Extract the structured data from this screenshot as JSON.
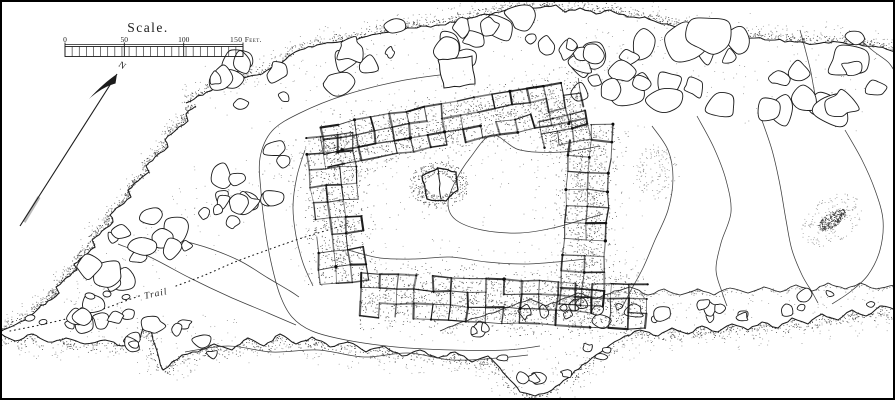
{
  "figure": {
    "kind": "archaeological-site-plan",
    "paper_color": "#ffffff",
    "ink_color": "#1c1c1c",
    "stipple_color": "#2e2e2e",
    "contour_color": "#3d3d3d"
  },
  "scale_bar": {
    "title": "Scale.",
    "labels": {
      "zero": "0",
      "fifty": "50",
      "hundred": "100",
      "end": "150 Feet."
    },
    "x0": 65,
    "x1": 243,
    "label_y": 41,
    "top_y": 44.5,
    "band_top": 46.5,
    "band_bottom": 56.5,
    "cells": 25
  },
  "north_arrow": {
    "label": "N",
    "tail": [
      20,
      226
    ],
    "tip": [
      117,
      74
    ],
    "label_pos": [
      122,
      65
    ],
    "label_rotation": 35
  },
  "trail": {
    "label": "Trail",
    "label_pos": [
      158,
      293
    ],
    "label_rotation": -12,
    "path_before": [
      [
        10,
        331
      ],
      [
        40,
        325
      ],
      [
        70,
        318
      ],
      [
        100,
        310
      ],
      [
        128,
        300
      ],
      [
        142,
        295
      ]
    ],
    "path_after": [
      [
        176,
        286
      ],
      [
        205,
        275
      ],
      [
        235,
        262
      ],
      [
        262,
        252
      ],
      [
        290,
        242
      ],
      [
        318,
        233
      ],
      [
        345,
        225
      ]
    ]
  },
  "cliffs": {
    "top_edge": [
      [
        186,
        103
      ],
      [
        215,
        88
      ],
      [
        242,
        78
      ],
      [
        262,
        74
      ],
      [
        285,
        60
      ],
      [
        300,
        50
      ],
      [
        322,
        44
      ],
      [
        352,
        40
      ],
      [
        382,
        33
      ],
      [
        412,
        28
      ],
      [
        440,
        25
      ],
      [
        470,
        18
      ],
      [
        500,
        12
      ],
      [
        530,
        8
      ],
      [
        556,
        5
      ],
      [
        565,
        12
      ],
      [
        580,
        8
      ],
      [
        596,
        14
      ],
      [
        610,
        10
      ],
      [
        628,
        17
      ],
      [
        645,
        17
      ],
      [
        662,
        24
      ],
      [
        680,
        27
      ],
      [
        700,
        29
      ],
      [
        715,
        33
      ],
      [
        735,
        37
      ],
      [
        755,
        38
      ],
      [
        775,
        40
      ],
      [
        795,
        42
      ],
      [
        815,
        44
      ],
      [
        838,
        42
      ],
      [
        858,
        44
      ],
      [
        878,
        47
      ],
      [
        895,
        52
      ]
    ],
    "left_edge": [
      [
        196,
        106
      ],
      [
        186,
        114
      ],
      [
        188,
        121
      ],
      [
        175,
        131
      ],
      [
        165,
        140
      ],
      [
        168,
        147
      ],
      [
        155,
        157
      ],
      [
        146,
        166
      ],
      [
        149,
        172
      ],
      [
        138,
        181
      ],
      [
        128,
        190
      ],
      [
        131,
        197
      ],
      [
        120,
        206
      ],
      [
        110,
        215
      ],
      [
        113,
        222
      ],
      [
        102,
        231
      ],
      [
        92,
        240
      ],
      [
        95,
        247
      ],
      [
        84,
        256
      ],
      [
        74,
        264
      ],
      [
        77,
        270
      ],
      [
        66,
        278
      ],
      [
        56,
        287
      ],
      [
        59,
        293
      ],
      [
        48,
        301
      ],
      [
        38,
        309
      ],
      [
        30,
        316
      ],
      [
        20,
        322
      ],
      [
        8,
        328
      ],
      [
        0,
        332
      ]
    ],
    "bottom_edge": [
      [
        0,
        333
      ],
      [
        15,
        341
      ],
      [
        32,
        334
      ],
      [
        48,
        342
      ],
      [
        66,
        338
      ],
      [
        85,
        344
      ],
      [
        105,
        340
      ],
      [
        122,
        346
      ],
      [
        138,
        342
      ],
      [
        147,
        320
      ],
      [
        155,
        345
      ],
      [
        163,
        370
      ],
      [
        172,
        362
      ],
      [
        182,
        355
      ],
      [
        198,
        352
      ],
      [
        214,
        344
      ],
      [
        232,
        350
      ],
      [
        248,
        338
      ],
      [
        264,
        346
      ],
      [
        280,
        334
      ],
      [
        296,
        344
      ],
      [
        312,
        337
      ],
      [
        330,
        347
      ],
      [
        348,
        342
      ],
      [
        366,
        352
      ],
      [
        384,
        346
      ],
      [
        402,
        356
      ],
      [
        420,
        350
      ],
      [
        438,
        358
      ],
      [
        455,
        352
      ],
      [
        472,
        362
      ],
      [
        488,
        356
      ],
      [
        500,
        368
      ],
      [
        510,
        380
      ],
      [
        520,
        392
      ],
      [
        535,
        396
      ],
      [
        552,
        390
      ],
      [
        568,
        378
      ],
      [
        582,
        365
      ],
      [
        596,
        355
      ],
      [
        610,
        345
      ],
      [
        625,
        336
      ],
      [
        640,
        330
      ],
      [
        658,
        336
      ],
      [
        672,
        328
      ],
      [
        688,
        334
      ],
      [
        702,
        326
      ],
      [
        718,
        332
      ],
      [
        732,
        324
      ],
      [
        748,
        330
      ],
      [
        762,
        322
      ],
      [
        778,
        328
      ],
      [
        792,
        318
      ],
      [
        808,
        324
      ],
      [
        822,
        314
      ],
      [
        838,
        320
      ],
      [
        852,
        310
      ],
      [
        866,
        316
      ],
      [
        880,
        306
      ],
      [
        895,
        310
      ]
    ],
    "terrace_edge": [
      [
        440,
        331
      ],
      [
        462,
        322
      ],
      [
        480,
        317
      ],
      [
        498,
        311
      ],
      [
        514,
        305
      ],
      [
        530,
        299
      ],
      [
        546,
        306
      ],
      [
        562,
        299
      ],
      [
        578,
        293
      ],
      [
        596,
        299
      ],
      [
        614,
        291
      ],
      [
        630,
        287
      ],
      [
        648,
        295
      ],
      [
        664,
        289
      ],
      [
        680,
        295
      ],
      [
        698,
        289
      ],
      [
        714,
        295
      ],
      [
        730,
        288
      ],
      [
        748,
        293
      ],
      [
        764,
        287
      ],
      [
        780,
        292
      ],
      [
        796,
        285
      ],
      [
        812,
        291
      ],
      [
        828,
        283
      ],
      [
        845,
        289
      ],
      [
        860,
        283
      ],
      [
        876,
        289
      ],
      [
        895,
        285
      ]
    ]
  },
  "contours": [
    {
      "name": "west-terrace-loop",
      "pts": [
        [
          455,
          73
        ],
        [
          400,
          81
        ],
        [
          345,
          95
        ],
        [
          300,
          113
        ],
        [
          272,
          131
        ],
        [
          260,
          158
        ],
        [
          261,
          192
        ],
        [
          265,
          228
        ],
        [
          271,
          262
        ],
        [
          280,
          295
        ],
        [
          292,
          317
        ],
        [
          312,
          331
        ],
        [
          346,
          340
        ],
        [
          396,
          347
        ],
        [
          452,
          350
        ],
        [
          506,
          350
        ],
        [
          540,
          346
        ]
      ]
    },
    {
      "name": "south-contour",
      "pts": [
        [
          185,
          352
        ],
        [
          228,
          346
        ],
        [
          272,
          352
        ],
        [
          318,
          350
        ],
        [
          364,
          357
        ],
        [
          408,
          353
        ],
        [
          452,
          360
        ],
        [
          498,
          358
        ],
        [
          528,
          355
        ]
      ]
    },
    {
      "name": "southwest-contour-a",
      "pts": [
        [
          118,
          244
        ],
        [
          150,
          257
        ],
        [
          190,
          278
        ],
        [
          230,
          297
        ],
        [
          268,
          313
        ],
        [
          296,
          325
        ]
      ]
    },
    {
      "name": "southwest-contour-b",
      "pts": [
        [
          188,
          242
        ],
        [
          214,
          250
        ],
        [
          242,
          262
        ],
        [
          268,
          278
        ],
        [
          290,
          291
        ],
        [
          299,
          297
        ]
      ]
    },
    {
      "name": "east-contour-1",
      "pts": [
        [
          652,
          126
        ],
        [
          668,
          150
        ],
        [
          673,
          178
        ],
        [
          668,
          210
        ],
        [
          655,
          240
        ],
        [
          643,
          268
        ],
        [
          630,
          292
        ],
        [
          622,
          308
        ]
      ]
    },
    {
      "name": "east-contour-2",
      "pts": [
        [
          697,
          116
        ],
        [
          714,
          148
        ],
        [
          726,
          180
        ],
        [
          731,
          212
        ],
        [
          721,
          243
        ],
        [
          716,
          270
        ],
        [
          722,
          292
        ],
        [
          727,
          306
        ]
      ]
    },
    {
      "name": "east-contour-3",
      "pts": [
        [
          760,
          115
        ],
        [
          772,
          150
        ],
        [
          780,
          185
        ],
        [
          786,
          220
        ],
        [
          792,
          250
        ],
        [
          802,
          275
        ],
        [
          812,
          292
        ],
        [
          818,
          303
        ]
      ]
    },
    {
      "name": "east-contour-4",
      "pts": [
        [
          845,
          130
        ],
        [
          862,
          160
        ],
        [
          875,
          190
        ],
        [
          883,
          220
        ],
        [
          880,
          250
        ],
        [
          868,
          275
        ],
        [
          850,
          292
        ],
        [
          832,
          304
        ]
      ]
    },
    {
      "name": "plaza-contour",
      "pts": [
        [
          600,
          146
        ],
        [
          562,
          152
        ],
        [
          520,
          150
        ],
        [
          492,
          135
        ],
        [
          470,
          158
        ],
        [
          455,
          182
        ],
        [
          448,
          204
        ],
        [
          456,
          220
        ],
        [
          482,
          230
        ],
        [
          520,
          233
        ],
        [
          553,
          228
        ],
        [
          582,
          220
        ],
        [
          603,
          214
        ]
      ]
    },
    {
      "name": "plaza-lower-contour",
      "pts": [
        [
          348,
          250
        ],
        [
          380,
          258
        ],
        [
          415,
          259
        ],
        [
          450,
          257
        ],
        [
          487,
          262
        ],
        [
          523,
          264
        ],
        [
          556,
          262
        ],
        [
          586,
          259
        ]
      ]
    },
    {
      "name": "west-wing-contour",
      "pts": [
        [
          305,
          150
        ],
        [
          297,
          176
        ],
        [
          293,
          206
        ],
        [
          296,
          236
        ],
        [
          303,
          263
        ],
        [
          313,
          286
        ]
      ]
    },
    {
      "name": "northeast-gully-1",
      "pts": [
        [
          800,
          30
        ],
        [
          810,
          68
        ],
        [
          818,
          104
        ],
        [
          836,
          127
        ]
      ]
    },
    {
      "name": "northeast-gully-2",
      "pts": [
        [
          852,
          32
        ],
        [
          872,
          50
        ],
        [
          888,
          62
        ],
        [
          895,
          72
        ]
      ]
    }
  ],
  "boulder_bands": [
    {
      "name": "top-talus",
      "axis": [
        [
          210,
          98
        ],
        [
          280,
          72
        ],
        [
          360,
          58
        ],
        [
          450,
          42
        ],
        [
          545,
          32
        ]
      ],
      "width": 52,
      "count": 26,
      "rmin": 5,
      "rmax": 14
    },
    {
      "name": "northeast-talus",
      "axis": [
        [
          580,
          50
        ],
        [
          660,
          62
        ],
        [
          730,
          72
        ],
        [
          800,
          68
        ],
        [
          880,
          70
        ]
      ],
      "width": 85,
      "count": 30,
      "rmin": 7,
      "rmax": 19
    },
    {
      "name": "west-talus",
      "axis": [
        [
          300,
          152
        ],
        [
          245,
          182
        ],
        [
          172,
          228
        ],
        [
          112,
          272
        ],
        [
          72,
          316
        ]
      ],
      "width": 58,
      "count": 30,
      "rmin": 5,
      "rmax": 13
    },
    {
      "name": "southwest-cluster",
      "axis": [
        [
          70,
          322
        ],
        [
          120,
          330
        ],
        [
          175,
          330
        ],
        [
          235,
          340
        ]
      ],
      "width": 38,
      "count": 13,
      "rmin": 4,
      "rmax": 9
    },
    {
      "name": "south-edge-rocks",
      "axis": [
        [
          450,
          325
        ],
        [
          520,
          315
        ],
        [
          600,
          312
        ],
        [
          700,
          312
        ],
        [
          800,
          302
        ],
        [
          880,
          298
        ]
      ],
      "width": 20,
      "count": 26,
      "rmin": 3.5,
      "rmax": 8
    },
    {
      "name": "south-lobe-rocks",
      "axis": [
        [
          500,
          358
        ],
        [
          535,
          382
        ],
        [
          575,
          360
        ],
        [
          608,
          348
        ]
      ],
      "width": 22,
      "count": 8,
      "rmin": 3.5,
      "rmax": 7
    },
    {
      "name": "northeast-gap-rocks",
      "axis": [
        [
          565,
          58
        ],
        [
          625,
          78
        ]
      ],
      "width": 36,
      "count": 7,
      "rmin": 6,
      "rmax": 13
    }
  ],
  "special_boulders": {
    "square_block": [
      [
        438,
        60
      ],
      [
        472,
        56
      ],
      [
        475,
        84
      ],
      [
        444,
        88
      ]
    ],
    "ovals": [
      [
        30,
        318,
        5,
        3
      ],
      [
        43,
        322,
        4,
        2.5
      ],
      [
        90,
        296,
        5,
        3
      ],
      [
        107,
        294,
        4,
        3
      ],
      [
        126,
        297,
        4,
        2.5
      ]
    ]
  },
  "ruin": {
    "wings": [
      {
        "name": "north-room-row",
        "x": 320,
        "y": 127,
        "angle": -10.5,
        "cols": 15,
        "rows": 3,
        "cw": 17.5,
        "ch": 13.5
      },
      {
        "name": "northeast-room-block",
        "x": 538,
        "y": 121,
        "angle": -12,
        "cols": 3,
        "rows": 2,
        "cw": 16,
        "ch": 14
      },
      {
        "name": "east-room-wing",
        "x": 612,
        "y": 125,
        "angle": 93,
        "cols": 11,
        "rows": 2,
        "cw": 16.5,
        "ch": 21
      },
      {
        "name": "south-room-row",
        "x": 362,
        "y": 273,
        "angle": 2.5,
        "cols": 16,
        "rows": 3,
        "cw": 17.8,
        "ch": 14.5
      },
      {
        "name": "west-room-wing",
        "x": 352,
        "y": 133,
        "angle": 84,
        "cols": 9,
        "rows": 3,
        "cw": 16.5,
        "ch": 15.5
      }
    ],
    "plaza_center": [
      460,
      195
    ],
    "central_structure": {
      "outline": [
        [
          422,
          176
        ],
        [
          438,
          168
        ],
        [
          456,
          172
        ],
        [
          458,
          190
        ],
        [
          446,
          201
        ],
        [
          427,
          199
        ]
      ],
      "divider": [
        [
          438,
          168
        ],
        [
          441,
          199
        ]
      ],
      "halo": [
        439,
        185,
        24,
        19
      ]
    },
    "northeast_stipple_cloud": [
      658,
      172,
      22,
      28
    ]
  },
  "mound": {
    "center": [
      832,
      220
    ],
    "rotation": -35,
    "core": [
      16,
      7
    ],
    "halo": [
      34,
      22
    ]
  }
}
